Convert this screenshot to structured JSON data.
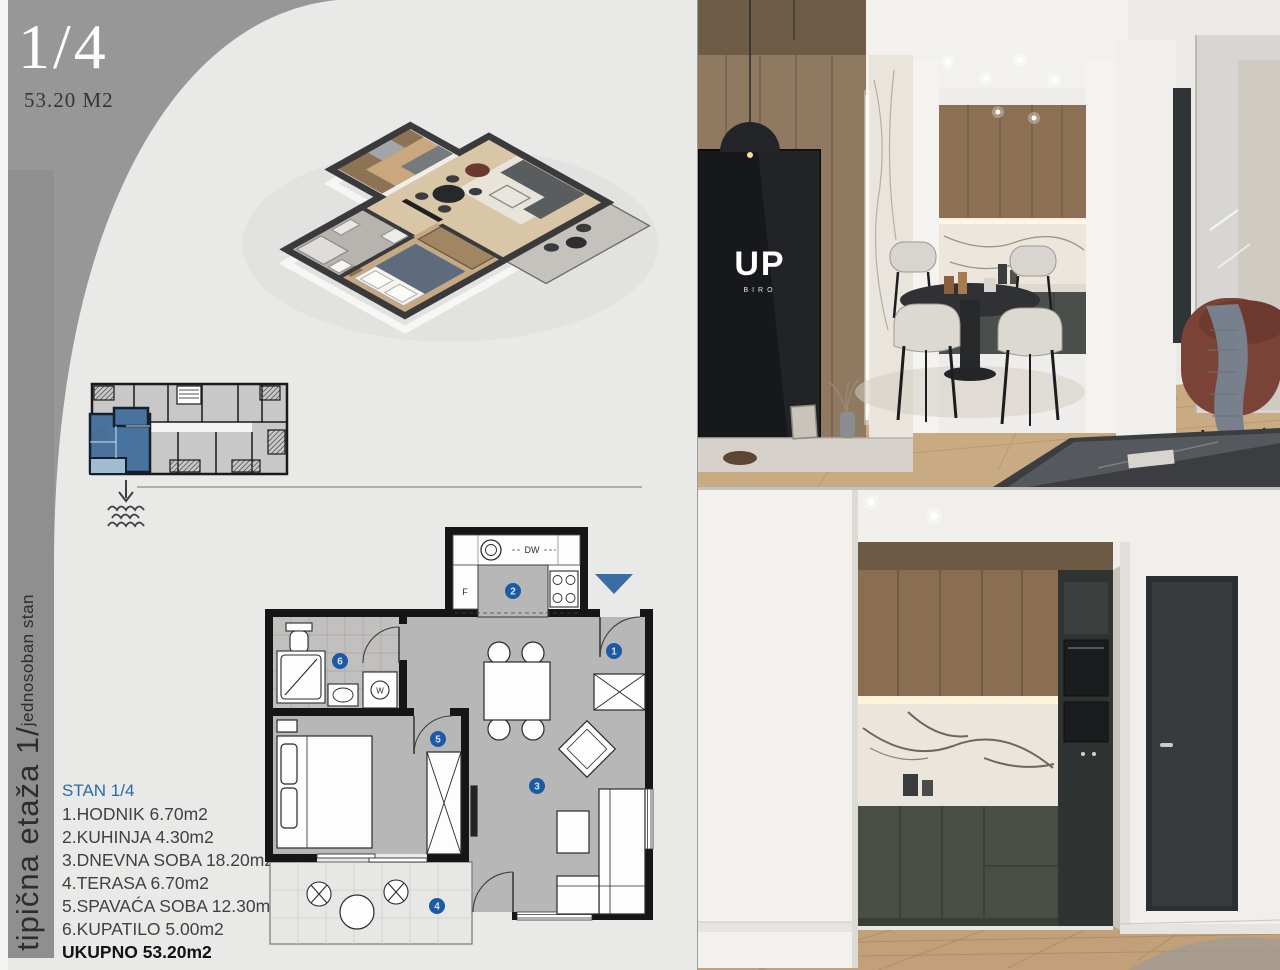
{
  "header": {
    "unit_number": "1/4",
    "unit_area": "53.20 M2"
  },
  "sidebar": {
    "label_main": "tipična etaža 1/",
    "label_sub": "jednosoban stan"
  },
  "room_list": {
    "title": "STAN 1/4",
    "items": [
      "1.HODNIK 6.70m2",
      "2.KUHINJA 4.30m2",
      "3.DNEVNA SOBA 18.20m2",
      "4.TERASA 6.70m2",
      "5.SPAVAĆA SOBA 12.30m2",
      "6.KUPATILO 5.00m2"
    ],
    "total": "UKUPNO 53.20m2"
  },
  "floor_plan": {
    "badges": {
      "hall": "1",
      "kitchen": "2",
      "living": "3",
      "terrace": "4",
      "bedroom": "5",
      "bathroom": "6"
    },
    "labels": {
      "fridge": "F",
      "dishwasher": "DW",
      "washer": "W"
    }
  },
  "photos": {
    "tv_logo": "UP",
    "tv_logo_sub": "BIRO"
  },
  "colors": {
    "page_bg": "#e9e9e8",
    "panel_gray": "#979797",
    "accent_blue": "#2b6aa3",
    "badge_blue": "#1d5aa4",
    "keyplan_blue": "#47739e"
  }
}
